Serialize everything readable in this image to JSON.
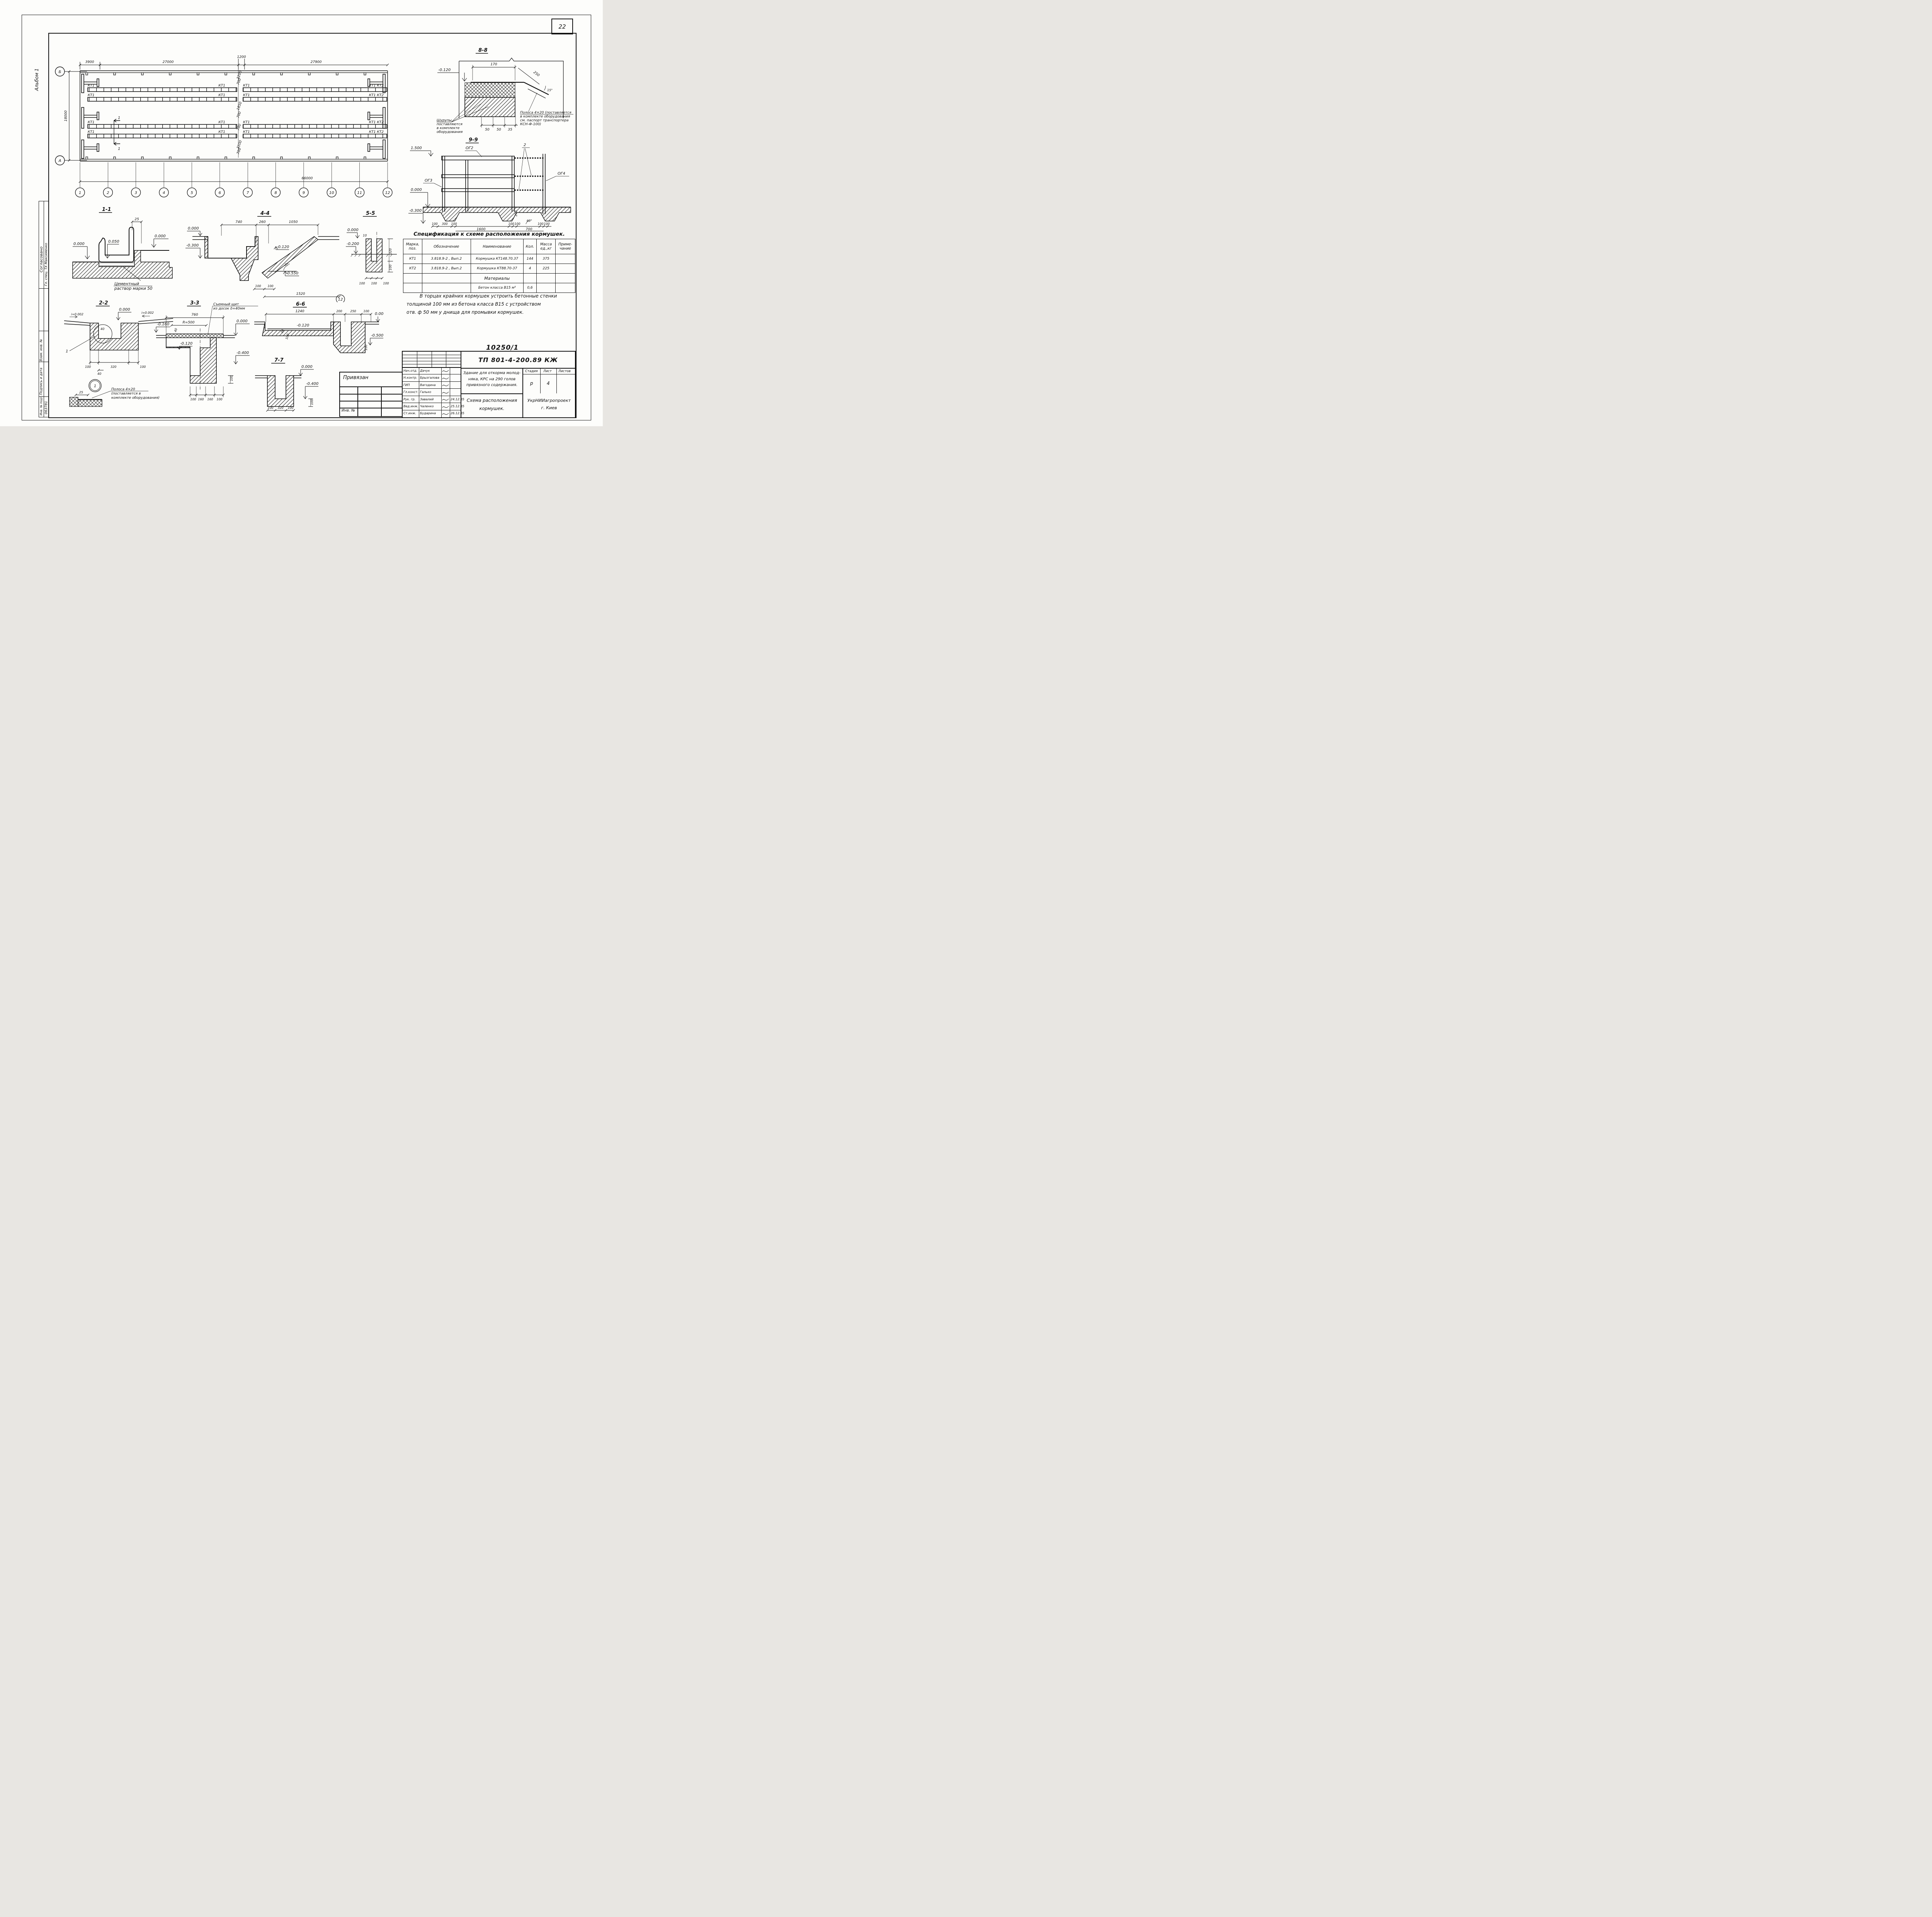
{
  "frame": {
    "page_number": "22",
    "album": "Альбом 1"
  },
  "stamp_left": {
    "agreed": "Согласовано",
    "agreed_by": "Гл. спец. ТХ  Максименко",
    "vzam": "Взам. инв. №",
    "podpis": "Подпись и дата",
    "inv_podl": "Инв. № подл.",
    "inv_num": "063781"
  },
  "doc_number": "10250/1",
  "attach": {
    "title": "Привязан",
    "inv": "Инв. №"
  },
  "plan": {
    "axis_top": "Б",
    "axis_bottom": "А",
    "dim_3900": "3900",
    "dim_27000": "27000",
    "dim_1200": "1200",
    "dim_27900": "27900",
    "dim_18000": "18000",
    "dim_66000": "66000",
    "lbl_kt1": "КТ1",
    "lbl_kt1kt2": "КТ1 КТ2",
    "cut_label": "1",
    "grid": [
      "1",
      "2",
      "3",
      "4",
      "5",
      "6",
      "7",
      "8",
      "9",
      "10",
      "11",
      "12"
    ],
    "dims_mid": [
      "3200",
      "700",
      "1850",
      "700",
      "700",
      "3100",
      "700"
    ]
  },
  "d88": {
    "title": "8-8",
    "elev": "-0.120",
    "dim_top": "170",
    "dim_diag": "250",
    "angle": "15°",
    "dims_bottom": [
      "50",
      "50",
      "35"
    ],
    "note_left1": "Шурупы",
    "note_left2": "поставляются",
    "note_left3": "в комплекте",
    "note_left4": "оборудования",
    "note_right1": "Полоса 4×20 (поставляется",
    "note_right2": "в комплекте оборудования",
    "note_right3": "см. паспорт транспортера",
    "note_right4": "КСН-Ф-100)"
  },
  "d99": {
    "title": "9-9",
    "elev_top": "1.500",
    "elev_zero": "0.000",
    "elev_bottom": "-0.300",
    "lbl_og2": "ОГ2",
    "lbl_og3": "ОГ3",
    "lbl_og4": "ОГ4",
    "lbl_2": "2",
    "angle": "60°",
    "dim_200": "200",
    "dims_b1": [
      "100",
      "300",
      "100"
    ],
    "dim_1600": "1600",
    "dims_b2": [
      "100",
      "100"
    ],
    "dim_700": "700",
    "dims_b3": [
      "100",
      "100"
    ]
  },
  "spec": {
    "title": "Спецификация к схеме расположения кормушек.",
    "headers": [
      "Марка, поз.",
      "Обозначение",
      "Наименование",
      "Кол.",
      "Масса ед.,кг",
      "Приме- чание"
    ],
    "rows": [
      [
        "КТ1",
        "3.818.9-2 ,  Вып.2",
        "Кормушка КТ148.70.37",
        "144",
        "375",
        ""
      ],
      [
        "КТ2",
        "3.818.9-2 ,  Вып.2",
        "Кормушка КТ88.70-37",
        "4",
        "225",
        ""
      ]
    ],
    "materials_label": "Материалы",
    "material_name": "Бетон класса В15   м³",
    "material_qty": "0,6"
  },
  "note": {
    "line1": "В торцах крайних кормушек устроить бетонные стенки",
    "line2": "толщиной 100 мм  из  бетона  класса  В15 с  устройством",
    "line3": "отв. ф 50 мм   у  днища  для  промывки  кормушек."
  },
  "s11": {
    "title": "1-1",
    "dim25": "25",
    "elev_l": "0.000",
    "elev_m": "0.050",
    "elev_r": "0.000",
    "note1": "Цементный",
    "note2": "раствор марки 50"
  },
  "s44": {
    "title": "4-4",
    "dim_740": "740",
    "dim_260": "260",
    "dim_1050": "1050",
    "elev_l1": "0.000",
    "elev_l2": "-0.300",
    "elev_m": "-0.120",
    "elev_b": "-0.550",
    "angle": "30°",
    "dim_100a": "100",
    "dim_100b": "100",
    "dim_total": "1520",
    "bubble": "12"
  },
  "s55": {
    "title": "5-5",
    "elev_t": "0.000",
    "elev_b": "-0.200",
    "dim10": "10",
    "dim320": "320",
    "dim100": "100",
    "dims_bottom": [
      "100",
      "100",
      "100"
    ]
  },
  "s22": {
    "title": "2-2",
    "slope_l": "i=0.002",
    "slope_r": "i=0.002",
    "elev_t": "0.000",
    "elev_r": "-0.160",
    "dim40a": "40",
    "dim_100a": "100",
    "dim_320": "320",
    "dim_100b": "100",
    "dim40b": "40",
    "lbl1": "1",
    "bubble": "1",
    "dim25": "25",
    "note1": "Полоса  4×20",
    "note2": "(поставляется  в",
    "note3": "комплекте оборудования)"
  },
  "s33": {
    "title": "3-3",
    "dim760": "760",
    "dimR": "R=500",
    "dim40": "40",
    "elev_t": "0.000",
    "elev_m": "-0.120",
    "elev_b": "-0.400",
    "dims_bottom": [
      "100",
      "160",
      "160",
      "100"
    ],
    "dim100": "100",
    "note1": "Съемный щит",
    "note2": "из досок δ=40мм"
  },
  "s66": {
    "title": "6-6",
    "dim_1240": "1240",
    "dim_200": "200",
    "dim_250": "250",
    "dim_100": "100",
    "elev_t": "0.000",
    "elev_m": "-0.120",
    "elev_b": "-0.500",
    "dim40": "40",
    "dim100a": "100",
    "dim100b": "100"
  },
  "s77": {
    "title": "7-7",
    "elev_t": "0.000",
    "elev_b": "-0.400",
    "dims_bottom": [
      "100",
      "320",
      "100"
    ],
    "dim100": "100"
  },
  "tb": {
    "doc": "ТП 801-4-200.89    КЖ",
    "rows": [
      {
        "role": "Нач.отд.",
        "name": "Дачук",
        "date": ""
      },
      {
        "role": "Н.контр.",
        "name": "Брызгалова",
        "date": ""
      },
      {
        "role": "ГИП",
        "name": "Вагодина",
        "date": ""
      },
      {
        "role": "Гл.конст.",
        "name": "Галько",
        "date": ""
      },
      {
        "role": "Рук. гр.",
        "name": "Завалий",
        "date": "24.12.85"
      },
      {
        "role": "Вед.инж.",
        "name": "Чаленко",
        "date": "25.12.85"
      },
      {
        "role": "Ст.инж.",
        "name": "Бударина",
        "date": "26.12.85"
      }
    ],
    "project1": "Здание для откорма молод-",
    "project2": "няка, КРС на 290 голов",
    "project3": "привязного содержания.",
    "stage_h": "Стадия",
    "sheet_h": "Лист",
    "sheets_h": "Листов",
    "stage_v": "р",
    "sheet_v": "4",
    "sheets_v": "",
    "drawing1": "Схема расположения",
    "drawing2": "кормушек.",
    "org1": "УкрНИИагропроект",
    "org2": "г. Киев"
  }
}
